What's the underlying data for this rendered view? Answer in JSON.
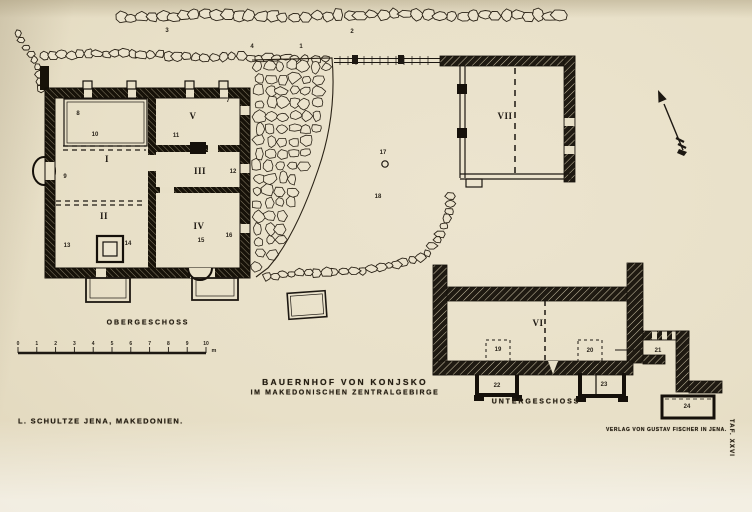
{
  "colors": {
    "paper": "#e8e0c8",
    "ink": "#2a241b",
    "wall": "#1a140c"
  },
  "captions": {
    "floor_upper": "OBERGESCHOSS",
    "floor_lower": "UNTERGESCHOSS",
    "title_line1": "BAUERNHOF VON KONJSKO",
    "title_line2": "IM MAKEDONISCHEN ZENTRALGEBIRGE",
    "author": "L. SCHULTZE JENA, MAKEDONIEN.",
    "publisher": "VERLAG VON GUSTAV FISCHER IN JENA.",
    "plate": "TAF. XXVI"
  },
  "scalebar": {
    "ticks": [
      "0",
      "1",
      "2",
      "3",
      "4",
      "5",
      "6",
      "7",
      "8",
      "9",
      "10"
    ],
    "unit": "m",
    "x_start": 18,
    "x_end": 206,
    "y": 353
  },
  "plan": {
    "rooms": [
      {
        "n": "I",
        "x": 107,
        "y": 159
      },
      {
        "n": "II",
        "x": 104,
        "y": 216
      },
      {
        "n": "III",
        "x": 200,
        "y": 171
      },
      {
        "n": "IV",
        "x": 199,
        "y": 226
      },
      {
        "n": "V",
        "x": 193,
        "y": 116
      },
      {
        "n": "VI",
        "x": 538,
        "y": 323
      },
      {
        "n": "VII",
        "x": 505,
        "y": 116
      }
    ],
    "features": [
      {
        "n": "1",
        "x": 301,
        "y": 47
      },
      {
        "n": "2",
        "x": 352,
        "y": 32
      },
      {
        "n": "3",
        "x": 167,
        "y": 31
      },
      {
        "n": "4",
        "x": 252,
        "y": 47
      },
      {
        "n": "7",
        "x": 228,
        "y": 101
      },
      {
        "n": "8",
        "x": 78,
        "y": 114
      },
      {
        "n": "9",
        "x": 65,
        "y": 177
      },
      {
        "n": "10",
        "x": 95,
        "y": 135
      },
      {
        "n": "11",
        "x": 176,
        "y": 136
      },
      {
        "n": "12",
        "x": 233,
        "y": 172
      },
      {
        "n": "13",
        "x": 67,
        "y": 246
      },
      {
        "n": "14",
        "x": 128,
        "y": 244
      },
      {
        "n": "15",
        "x": 201,
        "y": 241
      },
      {
        "n": "16",
        "x": 229,
        "y": 236
      },
      {
        "n": "17",
        "x": 383,
        "y": 153
      },
      {
        "n": "18",
        "x": 378,
        "y": 197
      },
      {
        "n": "19",
        "x": 498,
        "y": 350
      },
      {
        "n": "20",
        "x": 590,
        "y": 351
      },
      {
        "n": "21",
        "x": 658,
        "y": 351
      },
      {
        "n": "22",
        "x": 497,
        "y": 386
      },
      {
        "n": "23",
        "x": 604,
        "y": 385
      },
      {
        "n": "24",
        "x": 687,
        "y": 407
      }
    ]
  }
}
